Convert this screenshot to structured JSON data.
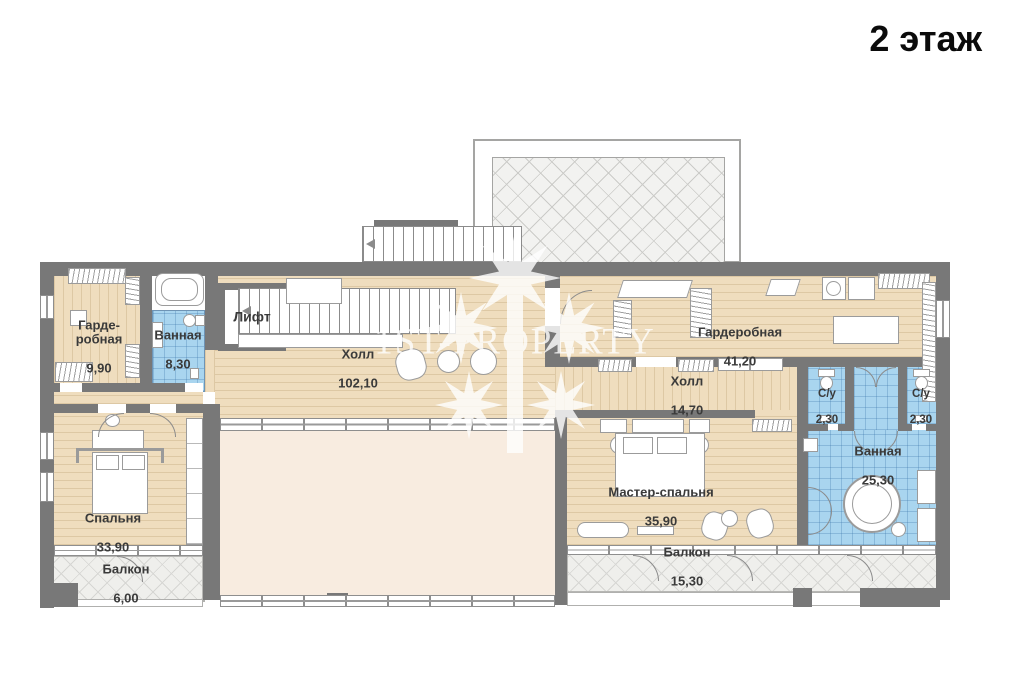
{
  "title": "2 этаж",
  "watermark": {
    "text": "1ST-PROPERTY",
    "icon": "palm-tree",
    "color": "#ffffff"
  },
  "rooms": {
    "wardrobe_left": {
      "name": "Гарде-\nробная",
      "area": "9,90"
    },
    "bathroom_small": {
      "name": "Ванная",
      "area": "8,30"
    },
    "elevator": {
      "name": "Лифт",
      "area": ""
    },
    "hall_main": {
      "name": "Холл",
      "area": "102,10"
    },
    "wardrobe_right": {
      "name": "Гардеробная",
      "area": "41,20"
    },
    "hall_small": {
      "name": "Холл",
      "area": "14,70"
    },
    "wc_left": {
      "name": "С/у",
      "area": "2,30"
    },
    "wc_right": {
      "name": "С/у",
      "area": "2,30"
    },
    "bathroom_master": {
      "name": "Ванная",
      "area": "25,30"
    },
    "master_bedroom": {
      "name": "Мастер-спальня",
      "area": "35,90"
    },
    "bedroom": {
      "name": "Спальня",
      "area": "33,90"
    },
    "balcony_left": {
      "name": "Балкон",
      "area": "6,00"
    },
    "balcony_right": {
      "name": "Балкон",
      "area": "15,30"
    }
  },
  "colors": {
    "wall": "#787878",
    "wood_floor": "#efddbe",
    "tile_floor": "#a9d5ef",
    "void_area": "#f8ece0",
    "balcony_hatch": "#efefec",
    "label_text": "#3a3a3a"
  }
}
